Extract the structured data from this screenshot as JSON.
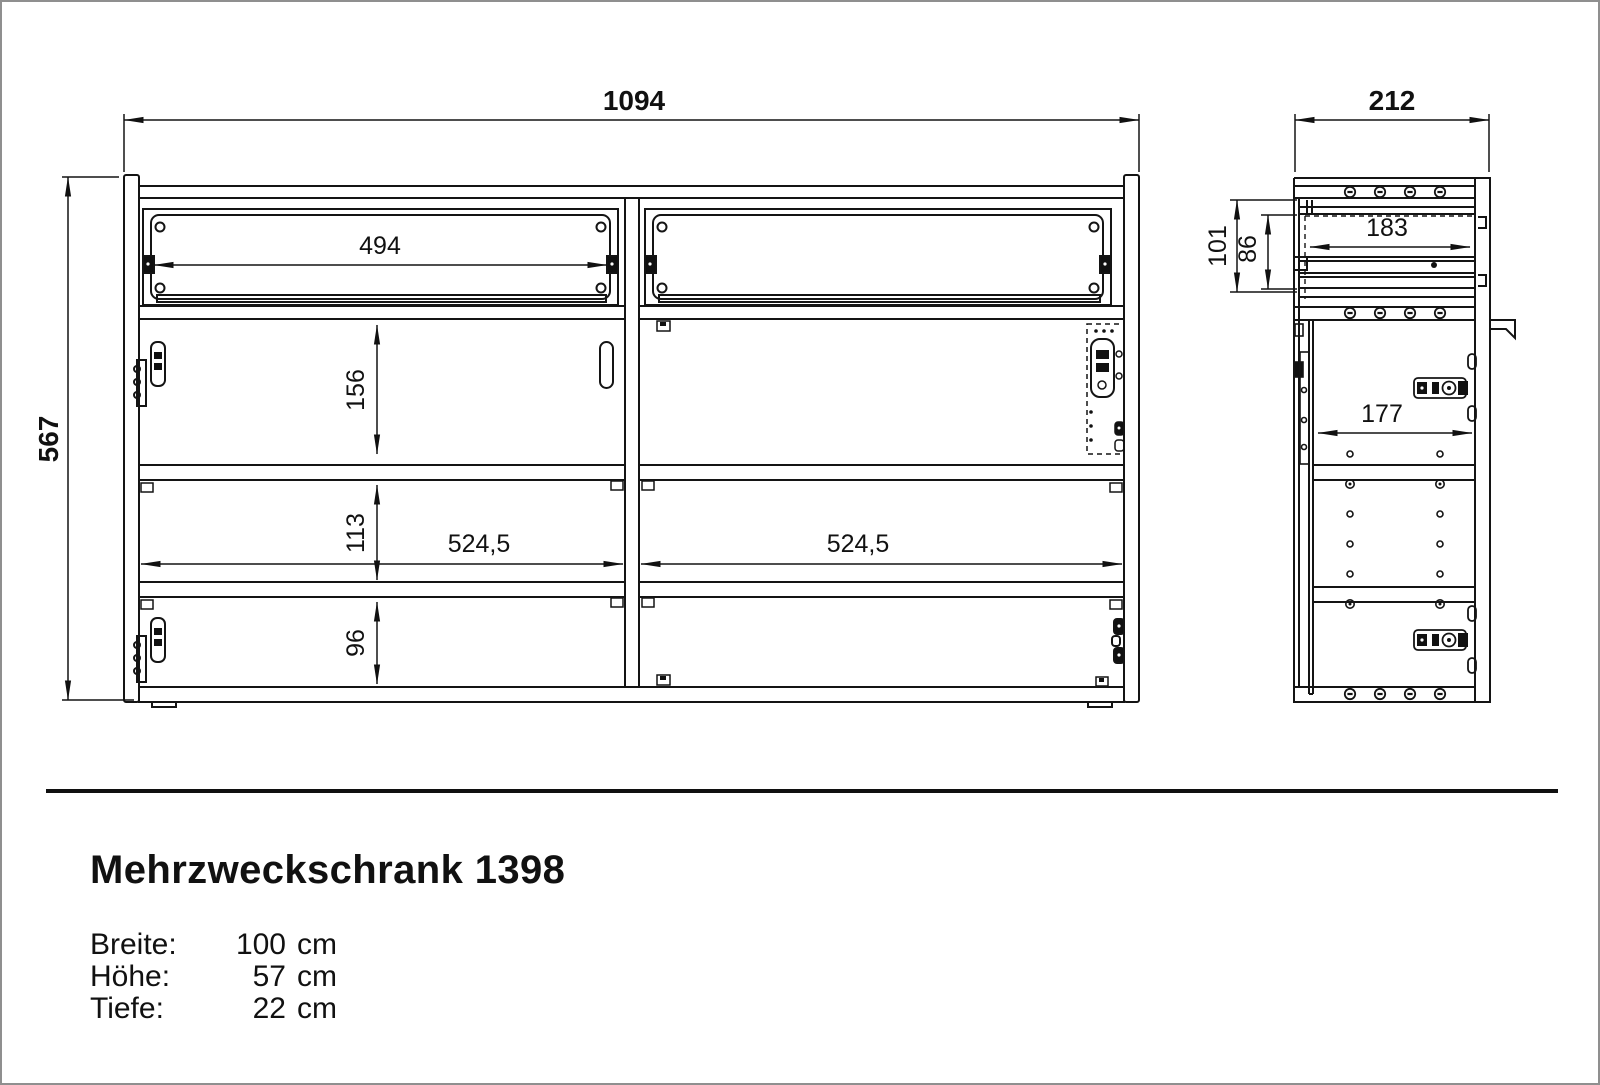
{
  "product": {
    "title": "Mehrzweckschrank 1398",
    "specs": [
      {
        "label": "Breite:",
        "value": "100",
        "unit": "cm"
      },
      {
        "label": "Höhe:",
        "value": "57",
        "unit": "cm"
      },
      {
        "label": "Tiefe:",
        "value": "22",
        "unit": "cm"
      }
    ]
  },
  "front_view": {
    "total_width": "1094",
    "total_height": "567",
    "flap_opening_width": "494",
    "top_compartment_height": "156",
    "middle_compartment_height": "113",
    "bottom_compartment_height": "96",
    "left_section_width": "524,5",
    "right_section_width": "524,5"
  },
  "side_view": {
    "total_depth": "212",
    "flap_total_depth": "101",
    "flap_inner_depth": "86",
    "flap_opening_depth": "183",
    "interior_depth": "177"
  }
}
